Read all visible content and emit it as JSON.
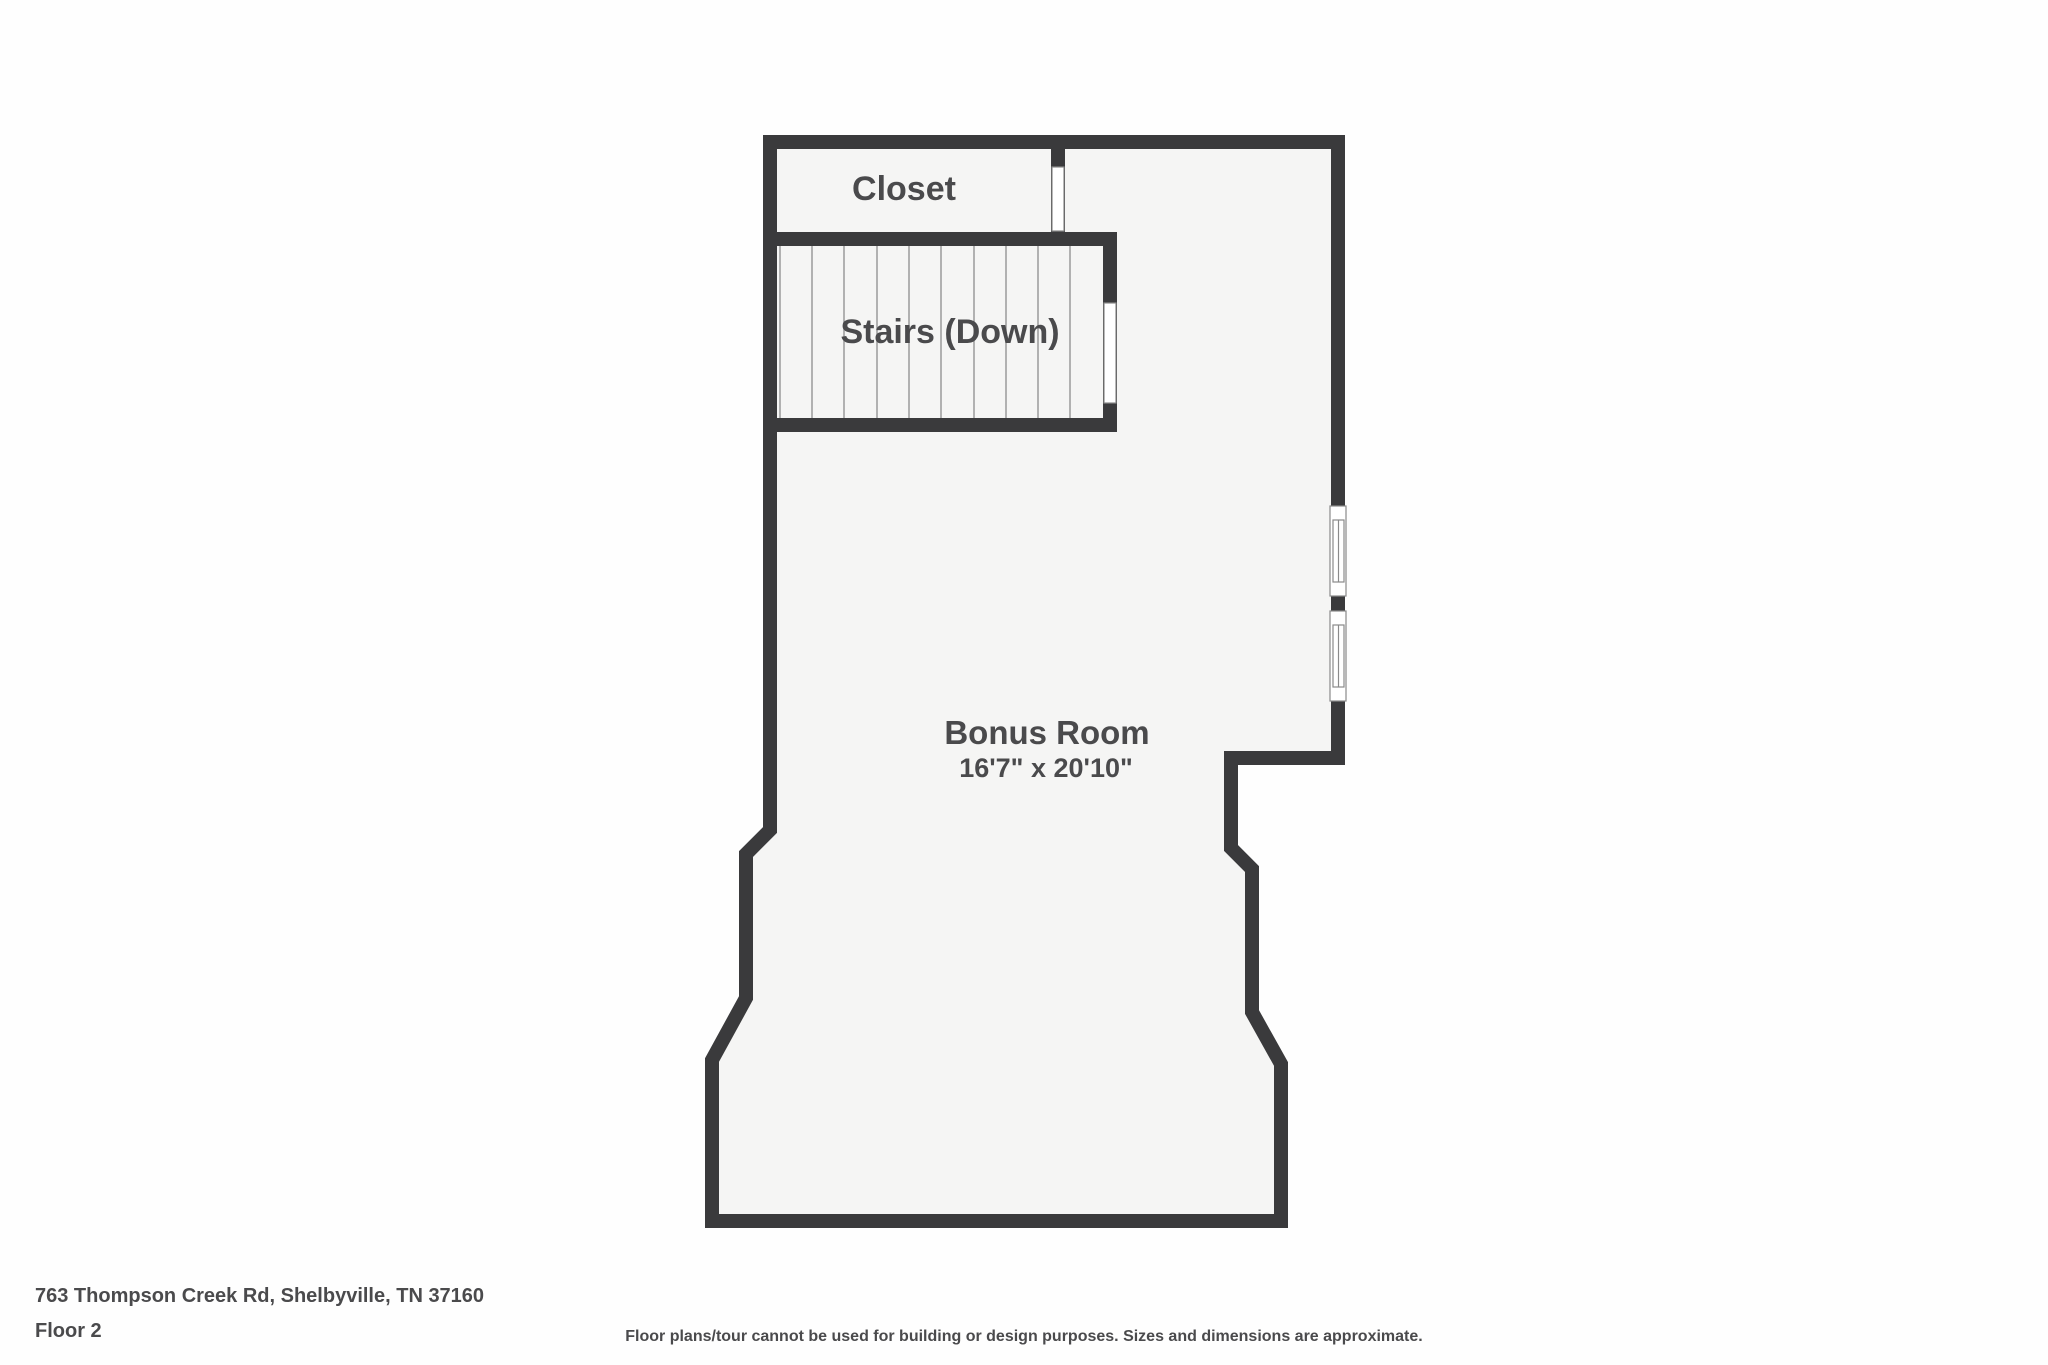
{
  "rooms": {
    "closet": {
      "label": "Closet"
    },
    "stairs": {
      "label": "Stairs (Down)"
    },
    "bonus_room": {
      "label": "Bonus Room",
      "dimensions": "16'7\" x 20'10\""
    }
  },
  "footer": {
    "address": "763 Thompson Creek Rd, Shelbyville, TN 37160",
    "floor": "Floor 2",
    "disclaimer": "Floor plans/tour cannot be used for building or design purposes. Sizes and dimensions are approximate."
  },
  "colors": {
    "wall": "#3a3a3c",
    "floor": "#f5f5f4",
    "page_bg": "#fefefe",
    "label_text": "#4a4a4c",
    "thin_line": "#a0a0a0",
    "frame_line": "#8a8a8a",
    "opening": "#ffffff"
  }
}
